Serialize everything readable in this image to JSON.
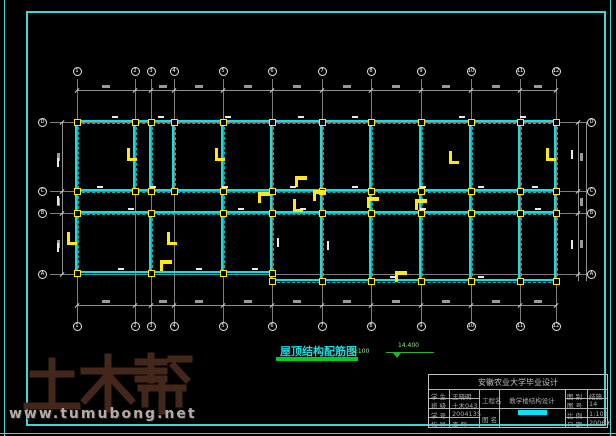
{
  "page": {
    "background": "#000000",
    "frame_color": "#3fd6d6",
    "beam_color": "#15dede",
    "column_color": "#ffe81a",
    "grid_color": "#7d7d7d",
    "title_color": "#22d8d8",
    "underline_color": "#00cc22"
  },
  "watermark": {
    "brand": "土木帮",
    "brand_color": "#44271b",
    "site": "www.tumubong.net",
    "site_color": "#b4aba2"
  },
  "drawing": {
    "title": "屋顶结构配筋图",
    "scale": "1:100",
    "elevation": "14.400",
    "grid_cols": [
      "1",
      "2",
      "3",
      "4",
      "5",
      "6",
      "7",
      "8",
      "9",
      "10",
      "11",
      "12"
    ],
    "grid_rows": [
      "D",
      "C",
      "B",
      "A"
    ]
  },
  "title_block": {
    "header": "安徽农业大学毕业设计",
    "info_rows": [
      {
        "label": "学 生",
        "value": "王晓明"
      },
      {
        "label": "班 级",
        "value": "土木043"
      },
      {
        "label": "学 号",
        "value": "2004135"
      },
      {
        "label": "指 导",
        "value": "李 强"
      }
    ],
    "project_label": "工程名",
    "project_name": "教学楼结构设计",
    "sheet_label": "图 名",
    "meta_rows": [
      {
        "label": "图 别",
        "value": "结施"
      },
      {
        "label": "图 号",
        "value": "14"
      },
      {
        "label": "比 例",
        "value": "1:100"
      },
      {
        "label": "日 期",
        "value": "2006.6"
      }
    ]
  }
}
